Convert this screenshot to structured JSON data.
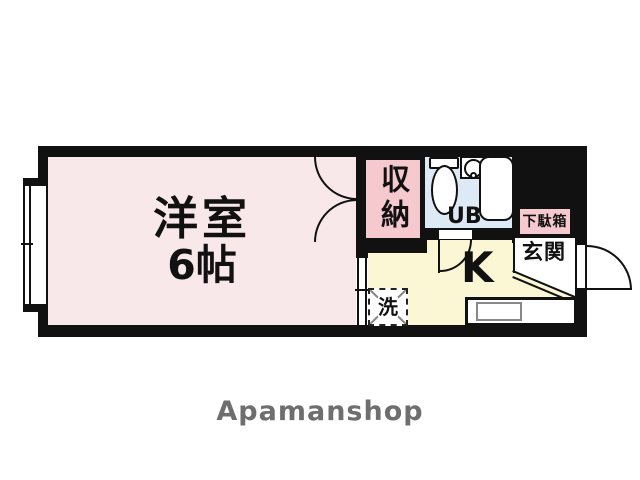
{
  "floorplan": {
    "rooms": {
      "main_room": {
        "name": "洋室",
        "size": "6帖",
        "color": "#f9e8ea"
      },
      "closet": {
        "label": "収納",
        "color": "#f6c9ce"
      },
      "unit_bath": {
        "label": "UB",
        "color": "#dde9f4"
      },
      "kitchen": {
        "label": "K",
        "color": "#fbf7d4"
      },
      "entrance": {
        "label": "玄関",
        "color": "#ffffff"
      },
      "shoe_cabinet": {
        "label": "下駄箱",
        "color": "#f6c9ce"
      },
      "washing_machine": {
        "label": "洗",
        "color": "#ffffff"
      }
    },
    "wall_color": "#111111"
  },
  "footer": {
    "brand": "Apamanshop",
    "brand_color": "#6e6e6e"
  }
}
